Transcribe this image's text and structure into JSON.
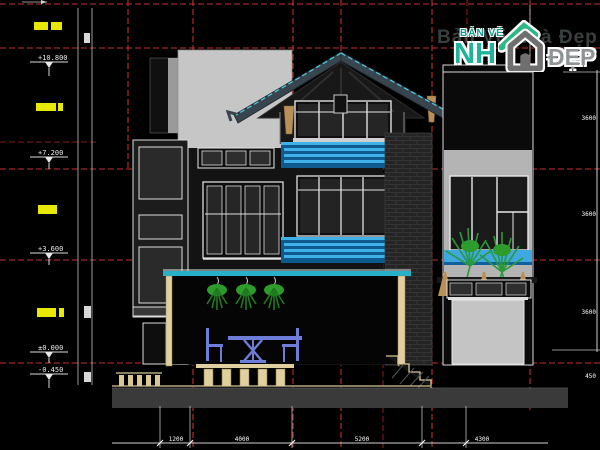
{
  "logo": {
    "badge_top": "BẢN VẼ",
    "badge_nh": "NH",
    "badge_dep": "ĐẸP",
    "watermark": "Bản Vẽ Nhà Đẹp"
  },
  "levels": [
    {
      "value": "+10.800"
    },
    {
      "value": "+7.200"
    },
    {
      "value": "+3.600"
    },
    {
      "value": "±0.000"
    },
    {
      "value": "-0.450"
    }
  ],
  "dimensions": {
    "bottom": [
      "1200",
      "4000",
      "5200",
      "4300"
    ],
    "right": [
      "3600",
      "3600",
      "3600",
      "450"
    ]
  },
  "colors": {
    "background": "#000000",
    "grid_red": "#c03030",
    "wall_gray": "#c6c6c6",
    "beam_teal": "#28b0c8",
    "railing_blue": "#3fb0e8",
    "plant_green": "#2d9c2d",
    "furniture_blue": "#6e7ed8",
    "wood_tan": "#e0d0a0",
    "highlight_yellow": "#e8e800",
    "logo_teal": "#1fb39a"
  }
}
